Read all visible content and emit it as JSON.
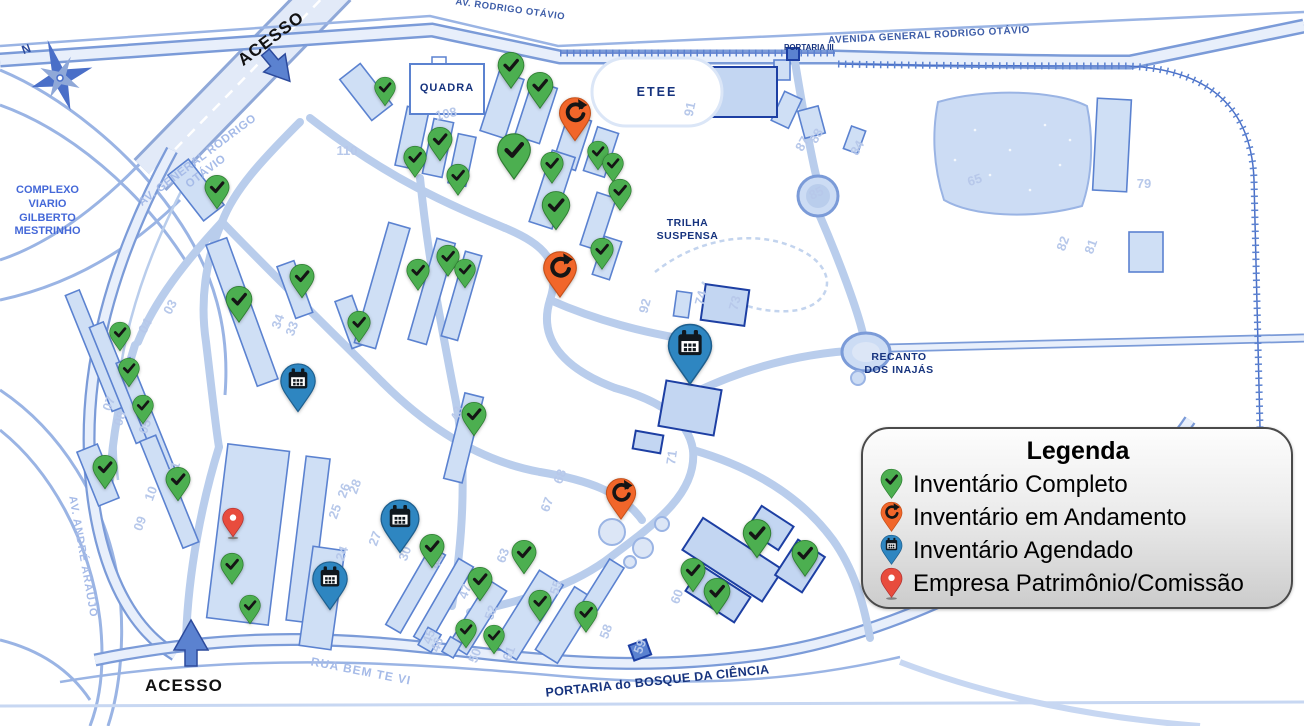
{
  "legend": {
    "title": "Legenda",
    "items": [
      {
        "label": "Inventário Completo",
        "type": "complete"
      },
      {
        "label": "Inventário em Andamento",
        "type": "in_progress"
      },
      {
        "label": "Inventário Agendado",
        "type": "scheduled"
      },
      {
        "label": "Empresa Patrimônio/Comissão",
        "type": "company"
      }
    ]
  },
  "colors": {
    "complete": "#4caf50",
    "in_progress": "#f1662a",
    "scheduled": "#2e86c1",
    "company": "#e84c3d"
  },
  "colors_dark": {
    "complete": "#2e7d32",
    "in_progress": "#c4501a",
    "scheduled": "#1e5f8e",
    "company": "#b03030"
  },
  "map_labels": {
    "north": "N",
    "acesso_top": "ACESSO",
    "acesso_bottom": "ACESSO",
    "av_rodrigo_otavio": "AV. RODRIGO OTÁVIO",
    "avenida_general": "AVENIDA GENERAL RODRIGO OTÁVIO",
    "portaria_iii": "PORTARIA III",
    "av_general_diag": "AV. GENERAL RODRIGO OTÁVIO",
    "complexo": "COMPLEXO\nVIARIO\nGILBERTO\nMESTRINHO",
    "av_andre_araujo": "AV. ANDRÉ ARAÚJO",
    "quadra": "QUADRA",
    "etee": "ETEE",
    "trilha": "TRILHA\nSUSPENSA",
    "recanto": "RECANTO\nDOS INAJÁS",
    "rua_bem_te_vi": "RUA BEM TE VI",
    "portaria_bosque": "PORTARIA do BOSQUE DA CIÊNCIA"
  },
  "markers": [
    {
      "type": "complete",
      "x": 385,
      "y": 88,
      "s": 24
    },
    {
      "type": "complete",
      "x": 511,
      "y": 66,
      "s": 30
    },
    {
      "type": "complete",
      "x": 540,
      "y": 86,
      "s": 30
    },
    {
      "type": "complete",
      "x": 440,
      "y": 140,
      "s": 28
    },
    {
      "type": "complete",
      "x": 514,
      "y": 150,
      "s": 38
    },
    {
      "type": "complete",
      "x": 415,
      "y": 158,
      "s": 26
    },
    {
      "type": "complete",
      "x": 458,
      "y": 176,
      "s": 26
    },
    {
      "type": "complete",
      "x": 552,
      "y": 164,
      "s": 26
    },
    {
      "type": "complete",
      "x": 598,
      "y": 152,
      "s": 24
    },
    {
      "type": "complete",
      "x": 613,
      "y": 164,
      "s": 24
    },
    {
      "type": "complete",
      "x": 620,
      "y": 191,
      "s": 26
    },
    {
      "type": "complete",
      "x": 556,
      "y": 206,
      "s": 32
    },
    {
      "type": "complete",
      "x": 602,
      "y": 250,
      "s": 26
    },
    {
      "type": "complete",
      "x": 217,
      "y": 188,
      "s": 28
    },
    {
      "type": "complete",
      "x": 448,
      "y": 257,
      "s": 26
    },
    {
      "type": "complete",
      "x": 418,
      "y": 271,
      "s": 26
    },
    {
      "type": "complete",
      "x": 465,
      "y": 270,
      "s": 24
    },
    {
      "type": "complete",
      "x": 302,
      "y": 277,
      "s": 28
    },
    {
      "type": "complete",
      "x": 239,
      "y": 300,
      "s": 30
    },
    {
      "type": "complete",
      "x": 359,
      "y": 323,
      "s": 26
    },
    {
      "type": "complete",
      "x": 120,
      "y": 333,
      "s": 24
    },
    {
      "type": "complete",
      "x": 129,
      "y": 369,
      "s": 24
    },
    {
      "type": "complete",
      "x": 143,
      "y": 406,
      "s": 24
    },
    {
      "type": "complete",
      "x": 105,
      "y": 468,
      "s": 28
    },
    {
      "type": "complete",
      "x": 178,
      "y": 480,
      "s": 28
    },
    {
      "type": "complete",
      "x": 474,
      "y": 415,
      "s": 28
    },
    {
      "type": "complete",
      "x": 232,
      "y": 565,
      "s": 26
    },
    {
      "type": "complete",
      "x": 250,
      "y": 606,
      "s": 24
    },
    {
      "type": "complete",
      "x": 432,
      "y": 547,
      "s": 28
    },
    {
      "type": "complete",
      "x": 480,
      "y": 580,
      "s": 28
    },
    {
      "type": "complete",
      "x": 466,
      "y": 630,
      "s": 24
    },
    {
      "type": "complete",
      "x": 494,
      "y": 636,
      "s": 24
    },
    {
      "type": "complete",
      "x": 524,
      "y": 553,
      "s": 28
    },
    {
      "type": "complete",
      "x": 540,
      "y": 602,
      "s": 26
    },
    {
      "type": "complete",
      "x": 586,
      "y": 613,
      "s": 26
    },
    {
      "type": "complete",
      "x": 693,
      "y": 571,
      "s": 28
    },
    {
      "type": "complete",
      "x": 717,
      "y": 592,
      "s": 30
    },
    {
      "type": "complete",
      "x": 757,
      "y": 534,
      "s": 32
    },
    {
      "type": "complete",
      "x": 805,
      "y": 554,
      "s": 30
    },
    {
      "type": "in_progress",
      "x": 575,
      "y": 113,
      "s": 36
    },
    {
      "type": "in_progress",
      "x": 560,
      "y": 268,
      "s": 38
    },
    {
      "type": "in_progress",
      "x": 621,
      "y": 494,
      "s": 34
    },
    {
      "type": "scheduled",
      "x": 298,
      "y": 381,
      "s": 40
    },
    {
      "type": "scheduled",
      "x": 690,
      "y": 346,
      "s": 50
    },
    {
      "type": "scheduled",
      "x": 400,
      "y": 519,
      "s": 44
    },
    {
      "type": "scheduled",
      "x": 330,
      "y": 579,
      "s": 40
    },
    {
      "type": "company",
      "x": 233,
      "y": 519,
      "s": 24
    }
  ],
  "building_numbers": [
    {
      "n": "108",
      "x": 447,
      "y": 118,
      "r": -12
    },
    {
      "n": "110",
      "x": 347,
      "y": 155,
      "r": 0
    },
    {
      "n": "91",
      "x": 694,
      "y": 110,
      "r": -78
    },
    {
      "n": "87",
      "x": 806,
      "y": 146,
      "r": -60
    },
    {
      "n": "88",
      "x": 820,
      "y": 138,
      "r": -60
    },
    {
      "n": "84",
      "x": 861,
      "y": 150,
      "r": -60
    },
    {
      "n": "85",
      "x": 818,
      "y": 197,
      "r": -25
    },
    {
      "n": "79",
      "x": 1144,
      "y": 188,
      "r": 0
    },
    {
      "n": "65",
      "x": 976,
      "y": 184,
      "r": -18
    },
    {
      "n": "82",
      "x": 1067,
      "y": 245,
      "r": -70
    },
    {
      "n": "81",
      "x": 1095,
      "y": 248,
      "r": -70
    },
    {
      "n": "92",
      "x": 649,
      "y": 307,
      "r": -75
    },
    {
      "n": "74",
      "x": 705,
      "y": 299,
      "r": -75
    },
    {
      "n": "73",
      "x": 739,
      "y": 304,
      "r": -75
    },
    {
      "n": "34",
      "x": 282,
      "y": 323,
      "r": -70
    },
    {
      "n": "33",
      "x": 296,
      "y": 330,
      "r": -70
    },
    {
      "n": "03",
      "x": 174,
      "y": 309,
      "r": -62
    },
    {
      "n": "04",
      "x": 149,
      "y": 328,
      "r": -62
    },
    {
      "n": "05",
      "x": 149,
      "y": 428,
      "r": -70
    },
    {
      "n": "07",
      "x": 113,
      "y": 405,
      "r": -70
    },
    {
      "n": "08",
      "x": 124,
      "y": 420,
      "r": -70
    },
    {
      "n": "09",
      "x": 144,
      "y": 525,
      "r": -70
    },
    {
      "n": "10",
      "x": 155,
      "y": 495,
      "r": -70
    },
    {
      "n": "11",
      "x": 178,
      "y": 470,
      "r": -70
    },
    {
      "n": "24",
      "x": 346,
      "y": 555,
      "r": -70
    },
    {
      "n": "25",
      "x": 339,
      "y": 513,
      "r": -70
    },
    {
      "n": "26",
      "x": 348,
      "y": 492,
      "r": -70
    },
    {
      "n": "27",
      "x": 379,
      "y": 540,
      "r": -70
    },
    {
      "n": "28",
      "x": 359,
      "y": 488,
      "r": -70
    },
    {
      "n": "30",
      "x": 409,
      "y": 555,
      "r": -70
    },
    {
      "n": "43",
      "x": 461,
      "y": 415,
      "r": -70
    },
    {
      "n": "44",
      "x": 441,
      "y": 563,
      "r": -70
    },
    {
      "n": "45",
      "x": 433,
      "y": 638,
      "r": -70
    },
    {
      "n": "46",
      "x": 441,
      "y": 646,
      "r": -70
    },
    {
      "n": "47",
      "x": 469,
      "y": 593,
      "r": -70
    },
    {
      "n": "50",
      "x": 479,
      "y": 657,
      "r": -70
    },
    {
      "n": "52",
      "x": 495,
      "y": 614,
      "r": -70
    },
    {
      "n": "55",
      "x": 560,
      "y": 589,
      "r": -70
    },
    {
      "n": "58",
      "x": 610,
      "y": 633,
      "r": -70
    },
    {
      "n": "59",
      "x": 644,
      "y": 648,
      "r": -70
    },
    {
      "n": "60",
      "x": 681,
      "y": 598,
      "r": -70
    },
    {
      "n": "61",
      "x": 513,
      "y": 655,
      "r": -70
    },
    {
      "n": "63",
      "x": 507,
      "y": 557,
      "r": -70
    },
    {
      "n": "67",
      "x": 551,
      "y": 506,
      "r": -70
    },
    {
      "n": "68",
      "x": 564,
      "y": 478,
      "r": -70
    },
    {
      "n": "71",
      "x": 676,
      "y": 458,
      "r": -82
    }
  ]
}
